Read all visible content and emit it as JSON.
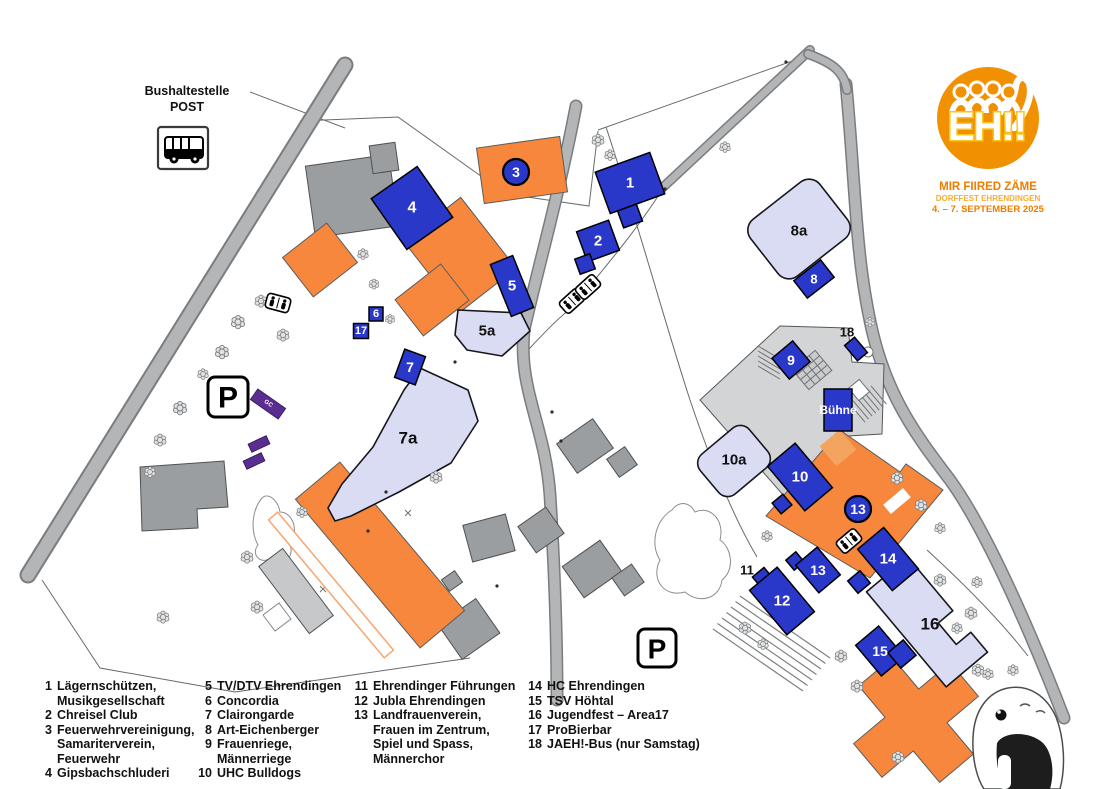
{
  "colors": {
    "booth_blue": "#2a38c9",
    "building_orange": "#f6873c",
    "zone_lavender": "#dadcf4",
    "gc_purple": "#5a2d90",
    "logo_orange": "#f19000",
    "logo_yellow": "#f8c51e",
    "logo_text_orange": "#ee7d00",
    "logo_text_amber": "#f3ae35"
  },
  "bus_stop": {
    "title": "Bushaltestelle",
    "subtitle": "POST"
  },
  "parking_label": "P",
  "stage_label": "Bühne",
  "gc_label": "GC",
  "logo": {
    "wordmark": "EH!!",
    "tagline": "MIR FIIRED ZÄME",
    "event": "DORFFEST EHRENDINGEN",
    "dates": "4. – 7. SEPTEMBER 2025"
  },
  "markers": {
    "m1": "1",
    "m2": "2",
    "m3": "3",
    "m4": "4",
    "m5": "5",
    "m6": "6",
    "m7": "7",
    "m8": "8",
    "m9": "9",
    "m10": "10",
    "m12": "12",
    "m13": "13",
    "m13c": "13",
    "m14": "14",
    "m15": "15",
    "m17": "17",
    "z5a": "5a",
    "z7a": "7a",
    "z8a": "8a",
    "z10a": "10a",
    "z16": "16",
    "l11": "11",
    "l18": "18"
  },
  "legend": {
    "columns": [
      [
        {
          "num": "1",
          "name": "Lägernschützen,\nMusikgesellschaft"
        },
        {
          "num": "2",
          "name": "Chreisel Club"
        },
        {
          "num": "3",
          "name": "Feuerwehrvereinigung,\nSamariterverein,\nFeuerwehr"
        },
        {
          "num": "4",
          "name": "Gipsbachschluderi"
        }
      ],
      [
        {
          "num": "5",
          "name": "TV/DTV Ehrendingen"
        },
        {
          "num": "6",
          "name": "Concordia"
        },
        {
          "num": "7",
          "name": "Clairongarde"
        },
        {
          "num": "8",
          "name": "Art-Eichenberger"
        },
        {
          "num": "9",
          "name": "Frauenriege,\nMännerriege"
        },
        {
          "num": "10",
          "name": "UHC Bulldogs"
        }
      ],
      [
        {
          "num": "11",
          "name": "Ehrendinger Führungen"
        },
        {
          "num": "12",
          "name": "Jubla Ehrendingen"
        },
        {
          "num": "13",
          "name": "Landfrauenverein,\nFrauen im Zentrum,\nSpiel und Spass,\nMännerchor"
        }
      ],
      [
        {
          "num": "14",
          "name": "HC Ehrendingen"
        },
        {
          "num": "15",
          "name": "TSV Höhtal"
        },
        {
          "num": "16",
          "name": "Jugendfest – Area17"
        },
        {
          "num": "17",
          "name": "ProBierbar"
        },
        {
          "num": "18",
          "name": "JAEH!-Bus (nur Samstag)"
        }
      ]
    ]
  }
}
